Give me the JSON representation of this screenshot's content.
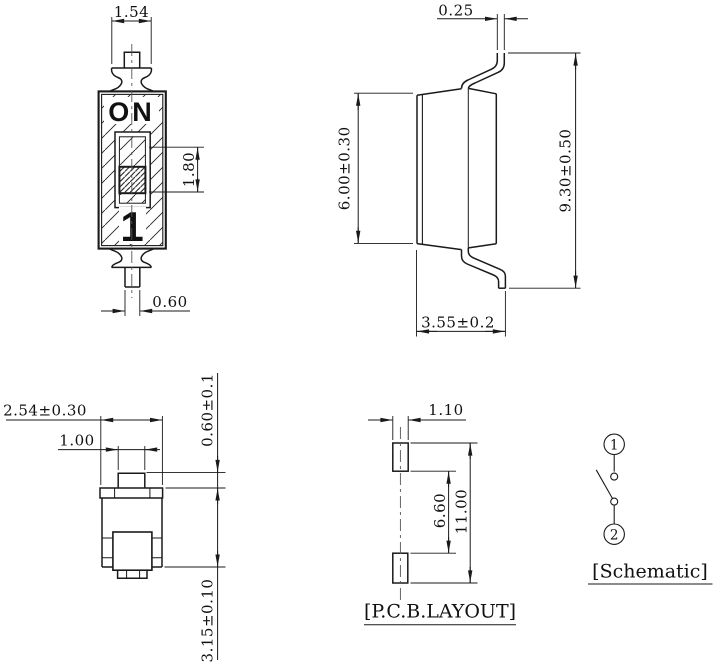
{
  "colors": {
    "line": "#1a1a1a",
    "centerline": "#555555",
    "background": "#ffffff"
  },
  "front_view": {
    "on_label": "ON",
    "position_label": "1",
    "dim_actuator_top_width": "1.54",
    "dim_slider_travel": "1.80",
    "dim_terminal_width": "0.60"
  },
  "side_view": {
    "dim_lead_thickness": "0.25",
    "dim_body_height": "6.00±0.30",
    "dim_overall_height": "9.30±0.50",
    "dim_body_depth": "3.55±0.2"
  },
  "end_view": {
    "dim_body_width": "2.54±0.30",
    "dim_actuator_width": "1.00",
    "dim_actuator_height": "0.60±0.1",
    "dim_body_thickness": "3.15±0.10"
  },
  "pcb_layout": {
    "label": "[P.C.B.LAYOUT]",
    "dim_pad_width": "1.10",
    "dim_pad_gap": "6.60",
    "dim_pad_span": "11.00"
  },
  "schematic": {
    "label": "[Schematic]",
    "terminal_1": "1",
    "terminal_2": "2"
  }
}
